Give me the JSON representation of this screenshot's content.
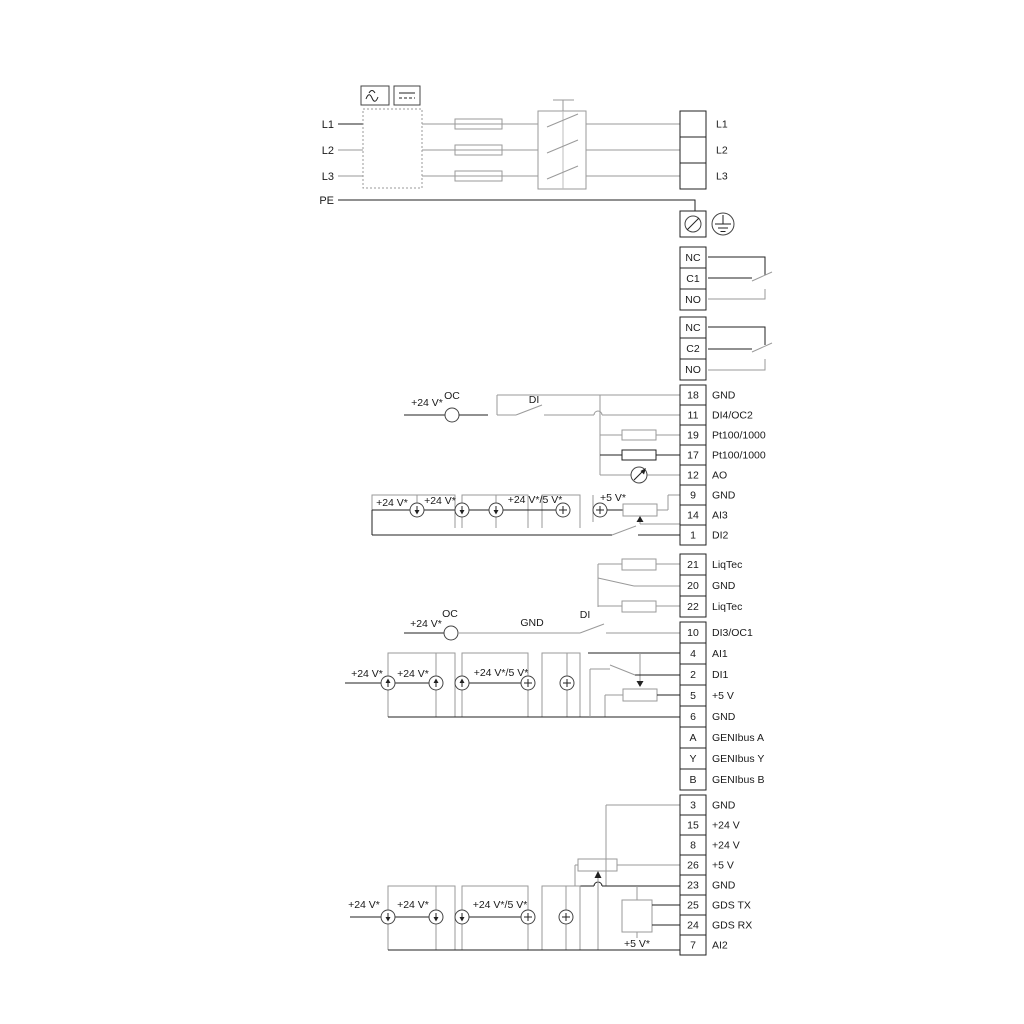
{
  "side_labels": {
    "l1": "L1",
    "l2": "L2",
    "l3": "L3",
    "pe": "PE"
  },
  "output_block": [
    "L1",
    "L2",
    "L3"
  ],
  "relay1": [
    "NC",
    "C1",
    "NO"
  ],
  "relay2": [
    "NC",
    "C2",
    "NO"
  ],
  "io1": [
    {
      "n": "18",
      "t": "GND"
    },
    {
      "n": "11",
      "t": "DI4/OC2"
    },
    {
      "n": "19",
      "t": "Pt100/1000"
    },
    {
      "n": "17",
      "t": "Pt100/1000"
    },
    {
      "n": "12",
      "t": "AO"
    },
    {
      "n": "9",
      "t": "GND"
    },
    {
      "n": "14",
      "t": "AI3"
    },
    {
      "n": "1",
      "t": "DI2"
    }
  ],
  "liqtec": [
    {
      "n": "21",
      "t": "LiqTec"
    },
    {
      "n": "20",
      "t": "GND"
    },
    {
      "n": "22",
      "t": "LiqTec"
    }
  ],
  "io2": [
    {
      "n": "10",
      "t": "DI3/OC1"
    },
    {
      "n": "4",
      "t": "AI1"
    },
    {
      "n": "2",
      "t": "DI1"
    },
    {
      "n": "5",
      "t": "+5 V"
    },
    {
      "n": "6",
      "t": "GND"
    },
    {
      "n": "A",
      "t": "GENIbus A"
    },
    {
      "n": "Y",
      "t": "GENIbus Y"
    },
    {
      "n": "B",
      "t": "GENIbus B"
    }
  ],
  "io3": [
    {
      "n": "3",
      "t": "GND"
    },
    {
      "n": "15",
      "t": "+24 V"
    },
    {
      "n": "8",
      "t": "+24 V"
    },
    {
      "n": "26",
      "t": "+5 V"
    },
    {
      "n": "23",
      "t": "GND"
    },
    {
      "n": "25",
      "t": "GDS TX"
    },
    {
      "n": "24",
      "t": "GDS RX"
    },
    {
      "n": "7",
      "t": "AI2"
    }
  ],
  "annotations": {
    "v24": "+24 V*",
    "v24v5": "+24 V*/5 V*",
    "v5": "+5 V*",
    "oc": "OC",
    "di": "DI",
    "gnd": "GND"
  }
}
